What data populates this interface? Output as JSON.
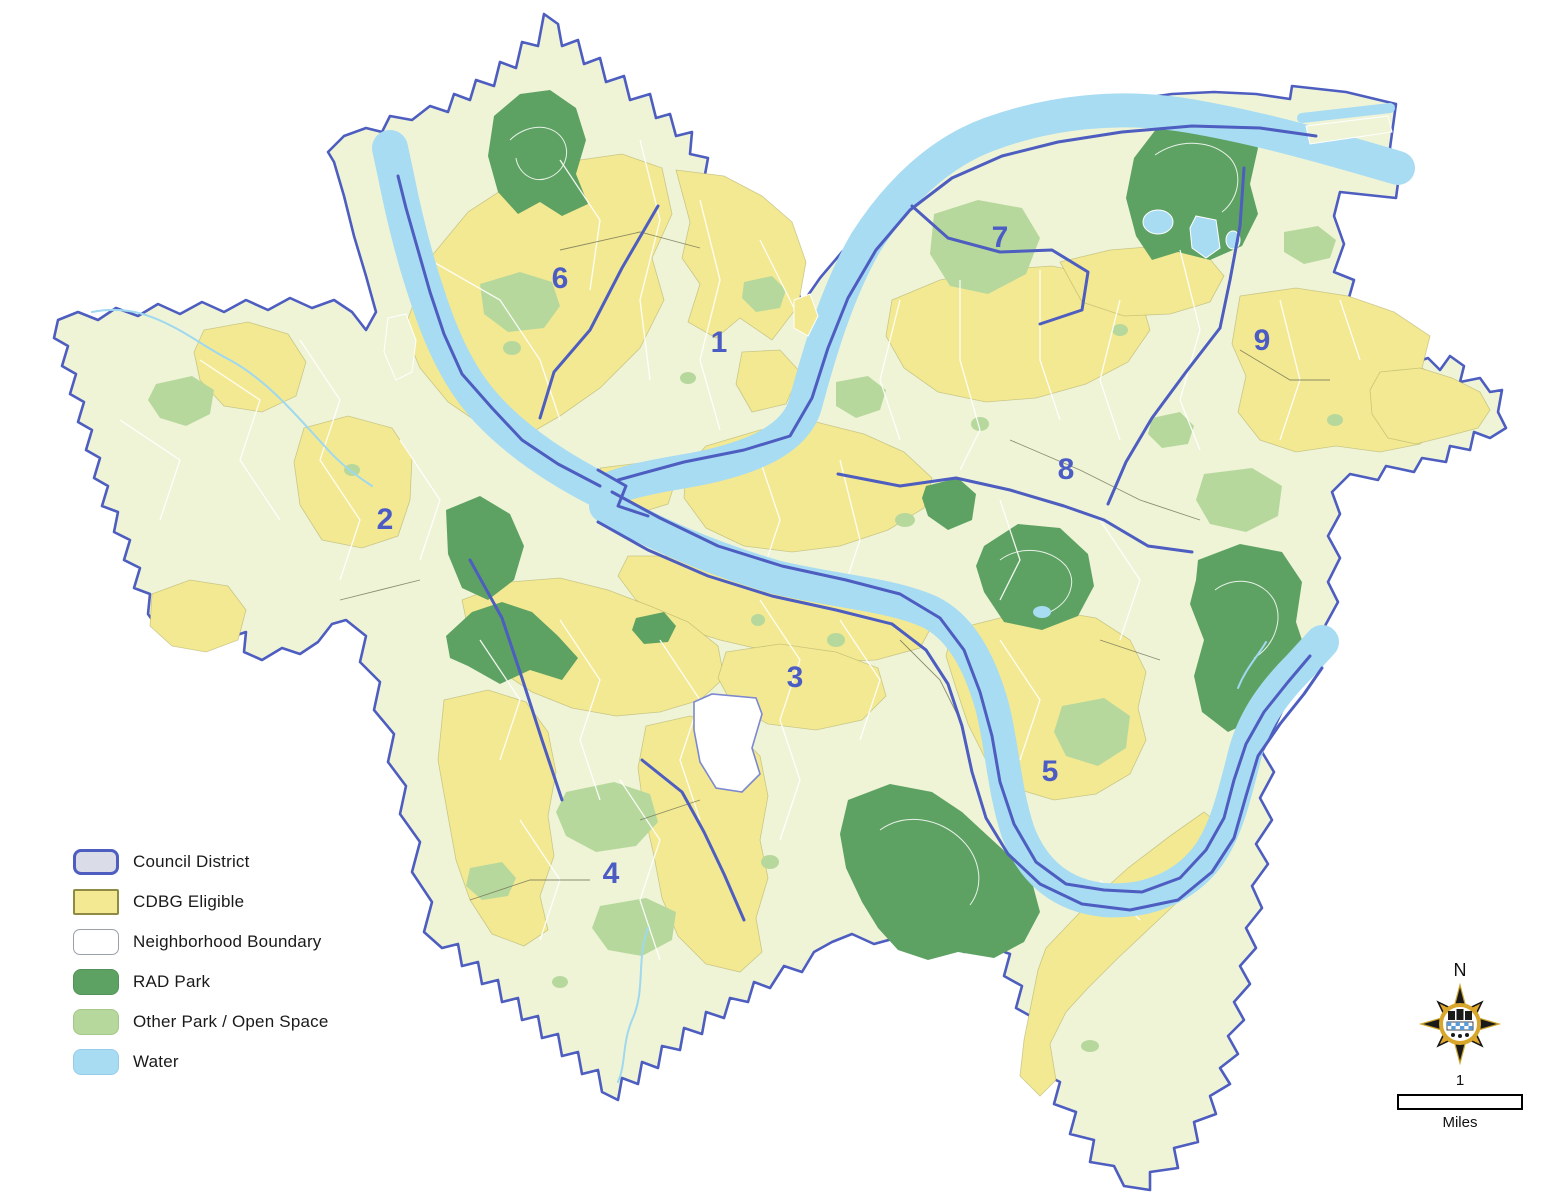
{
  "legend": {
    "items": [
      {
        "label": "Council District"
      },
      {
        "label": "CDBG Eligible"
      },
      {
        "label": "Neighborhood Boundary"
      },
      {
        "label": "RAD Park"
      },
      {
        "label": "Other Park / Open Space"
      },
      {
        "label": "Water"
      }
    ]
  },
  "districts": [
    {
      "label": "1"
    },
    {
      "label": "2"
    },
    {
      "label": "3"
    },
    {
      "label": "4"
    },
    {
      "label": "5"
    },
    {
      "label": "6"
    },
    {
      "label": "7"
    },
    {
      "label": "8"
    },
    {
      "label": "9"
    }
  ],
  "compass": {
    "north_label": "N"
  },
  "scale_bar": {
    "distance_label": "1",
    "unit_label": "Miles"
  },
  "colors": {
    "council_district_fill": "#dadce8",
    "district_boundary": "#4d5dc0",
    "cdbg_eligible": "#f3e992",
    "neighborhood_boundary_fill": "#ffffff",
    "rad_park": "#5ea263",
    "other_park_open_space": "#b7d89d",
    "water": "#a8dcf2",
    "city_base": "#eff4d7"
  }
}
